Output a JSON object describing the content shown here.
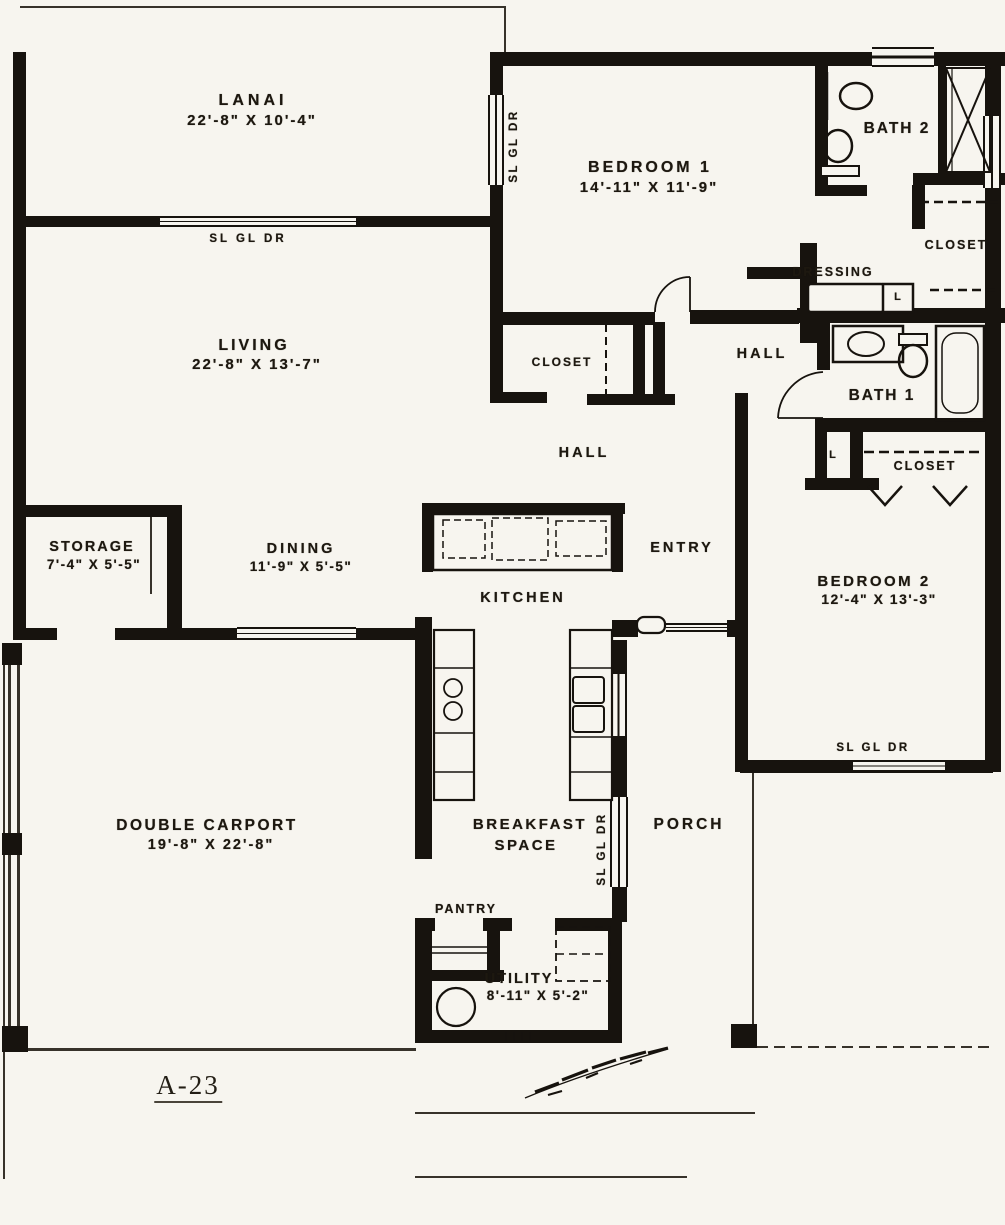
{
  "plan": {
    "number": "A-23"
  },
  "colors": {
    "paper": "#f7f5ef",
    "ink": "#17130e"
  },
  "rooms": [
    {
      "name": "lanai",
      "label": "LANAI",
      "dims": "22'-8\" X 10'-4\""
    },
    {
      "name": "bedroom-1",
      "label": "BEDROOM 1",
      "dims": "14'-11\" X 11'-9\""
    },
    {
      "name": "bath-2",
      "label": "BATH 2"
    },
    {
      "name": "closet-top",
      "label": "CLOSET"
    },
    {
      "name": "dressing",
      "label": "DRESSING"
    },
    {
      "name": "hall-upper",
      "label": "HALL"
    },
    {
      "name": "bath-1",
      "label": "BATH 1"
    },
    {
      "name": "linen-upper",
      "label": "L"
    },
    {
      "name": "closet-mid",
      "label": "CLOSET"
    },
    {
      "name": "linen-lower",
      "label": "L"
    },
    {
      "name": "living",
      "label": "LIVING",
      "dims": "22'-8\" X 13'-7\""
    },
    {
      "name": "closet-bedroom1",
      "label": "CLOSET"
    },
    {
      "name": "hall-lower",
      "label": "HALL"
    },
    {
      "name": "storage",
      "label": "STORAGE",
      "dims": "7'-4\" X 5'-5\""
    },
    {
      "name": "dining",
      "label": "DINING",
      "dims": "11'-9\" X 5'-5\""
    },
    {
      "name": "entry",
      "label": "ENTRY"
    },
    {
      "name": "kitchen",
      "label": "KITCHEN"
    },
    {
      "name": "bedroom-2",
      "label": "BEDROOM 2",
      "dims": "12'-4\" X 13'-3\""
    },
    {
      "name": "double-carport",
      "label": "DOUBLE CARPORT",
      "dims": "19'-8\" X 22'-8\""
    },
    {
      "name": "breakfast-space",
      "label": "BREAKFAST",
      "label2": "SPACE"
    },
    {
      "name": "porch",
      "label": "PORCH"
    },
    {
      "name": "pantry",
      "label": "PANTRY"
    },
    {
      "name": "utility",
      "label": "UTILITY",
      "dims": "8'-11\" X 5'-2\""
    }
  ],
  "door_labels": [
    {
      "name": "lanai-slider",
      "text": "SL GL DR"
    },
    {
      "name": "bedroom-1-slider",
      "text": "SL GL DR"
    },
    {
      "name": "breakfast-slider",
      "text": "SL GL DR"
    },
    {
      "name": "bedroom-2-slider",
      "text": "SL GL DR"
    }
  ]
}
